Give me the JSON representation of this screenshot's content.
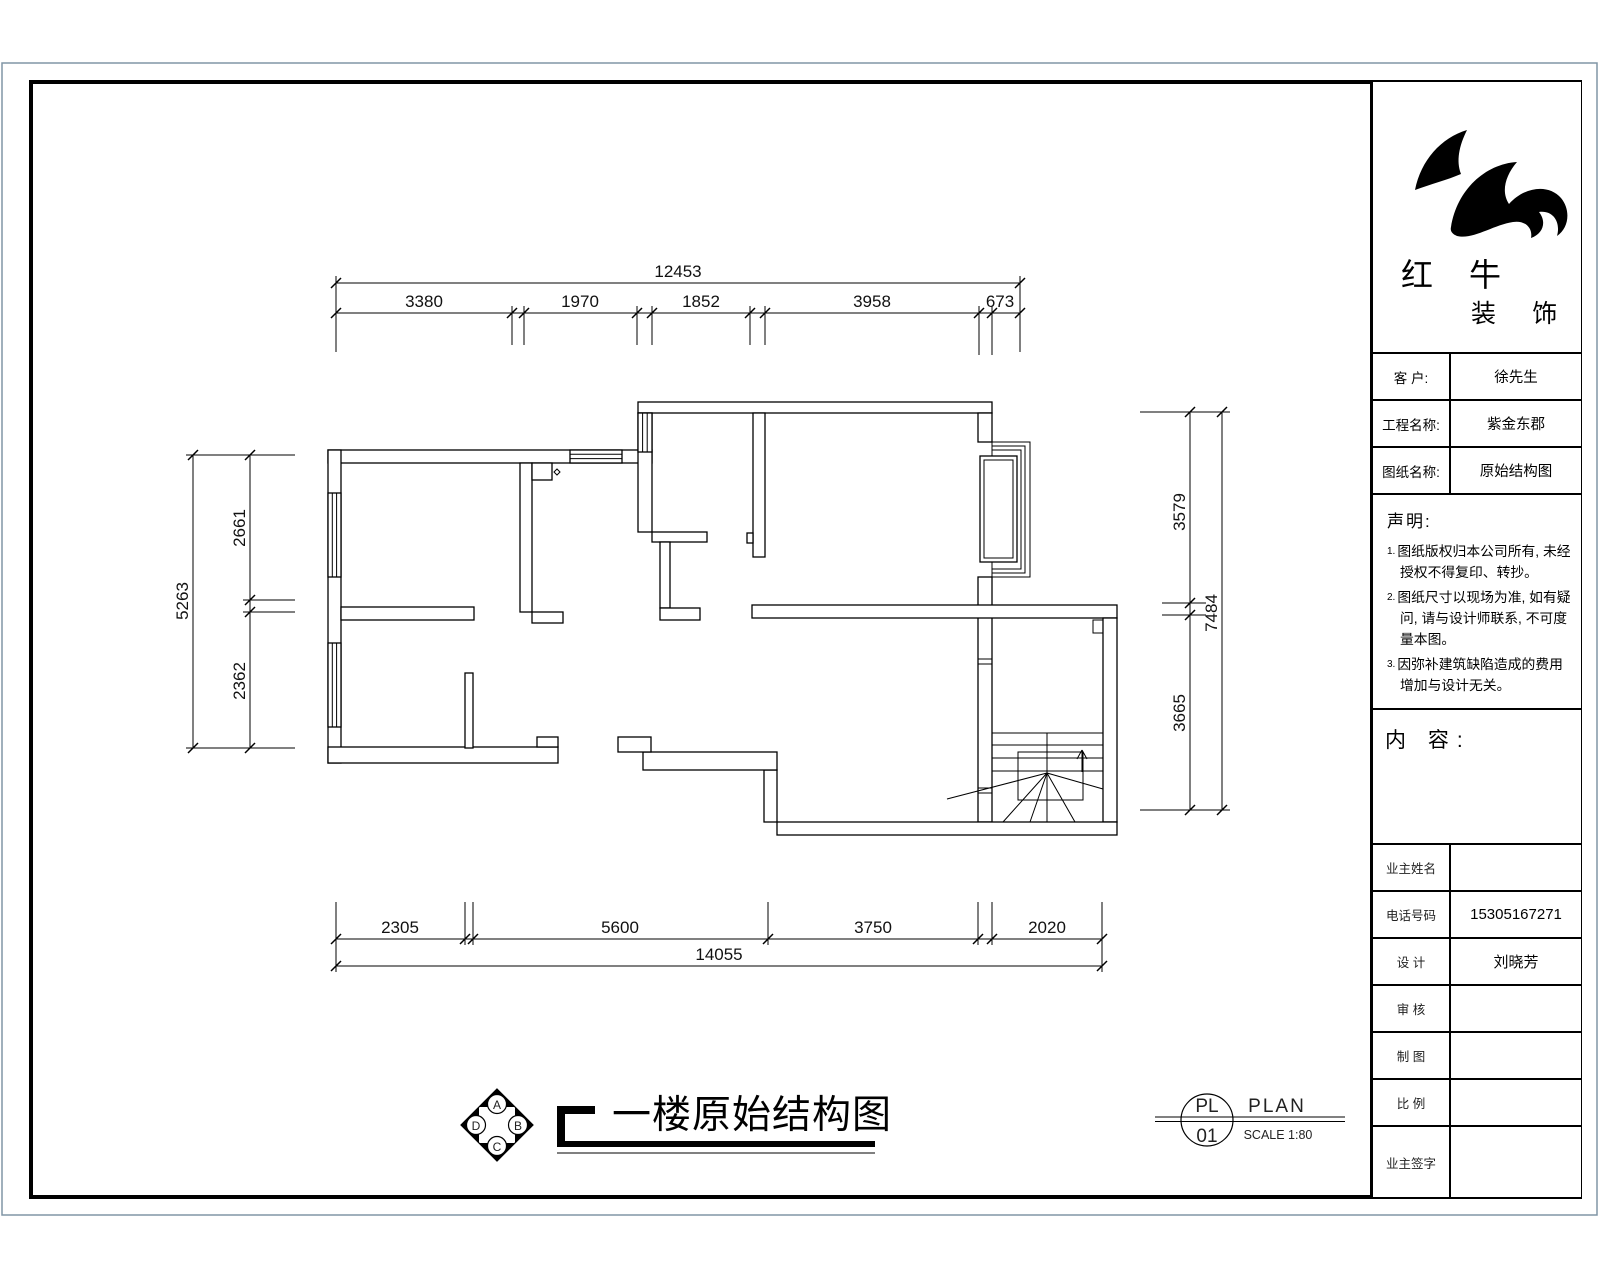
{
  "title_block": {
    "logo": {
      "name_cn": "红 牛",
      "sub_cn": "装 饰"
    },
    "info_rows": [
      {
        "label": "客  户:",
        "value": "徐先生"
      },
      {
        "label": "工程名称:",
        "value": "紫金东郡"
      },
      {
        "label": "图纸名称:",
        "value": "原始结构图"
      }
    ],
    "declaration": {
      "heading": "声明:",
      "items": [
        {
          "num": "1.",
          "text": "图纸版权归本公司所有, 未经授权不得复印、转抄。"
        },
        {
          "num": "2.",
          "text": "图纸尺寸以现场为准, 如有疑问, 请与设计师联系, 不可度量本图。"
        },
        {
          "num": "3.",
          "text": "因弥补建筑缺陷造成的费用增加与设计无关。"
        }
      ]
    },
    "content_heading": "内 容:",
    "sign_rows": [
      {
        "label": "业主姓名",
        "value": ""
      },
      {
        "label": "电话号码",
        "value": "15305167271"
      },
      {
        "label": "设  计",
        "value": "刘晓芳"
      },
      {
        "label": "审  核",
        "value": ""
      },
      {
        "label": "制  图",
        "value": ""
      },
      {
        "label": "比  例",
        "value": ""
      },
      {
        "label": "业主签字",
        "value": ""
      }
    ]
  },
  "drawing_title": {
    "text": "一楼原始结构图"
  },
  "compass": {
    "top": "A",
    "right": "B",
    "bottom": "C",
    "left": "D"
  },
  "plan_ref": {
    "code_top": "PL",
    "code_bottom": "01",
    "label": "PLAN",
    "scale": "SCALE 1:80"
  },
  "dimensions": {
    "top": {
      "total": "12453",
      "segments": [
        "3380",
        "1970",
        "1852",
        "3958",
        "673"
      ]
    },
    "bottom": {
      "total": "14055",
      "segments": [
        "2305",
        "5600",
        "3750",
        "2020"
      ]
    },
    "left": {
      "total": "5263",
      "segments": [
        "2661",
        "2362"
      ]
    },
    "right": {
      "total": "7484",
      "segments": [
        "3579",
        "3665"
      ]
    }
  }
}
